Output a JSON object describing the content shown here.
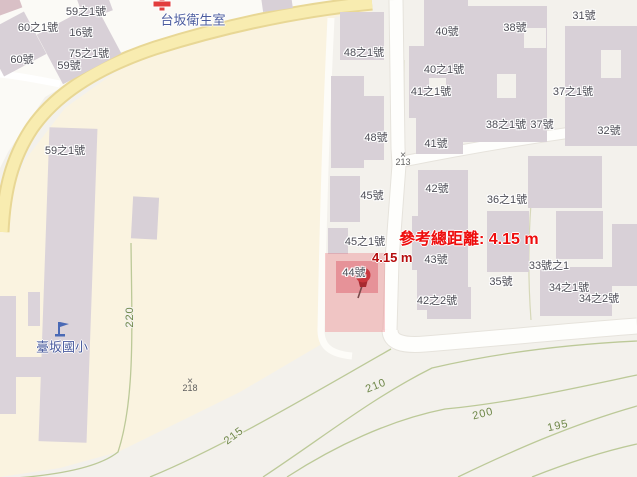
{
  "window": {
    "width": 637,
    "height": 477
  },
  "map": {
    "type": "topographic-street-map",
    "colors": {
      "building": "#d8d0d7",
      "school_ground": "#faf3e0",
      "background": "#f3f1ec",
      "road_yellow": "#f8ecb0",
      "road_white": "#fefefc",
      "contour_green": "#bcc998",
      "contour_label_green": "#6e8748",
      "place_label_blue": "#4a5b9e",
      "building_label_gray": "#4c4c55",
      "measurement_red": "#ee0d0d",
      "segment_red": "#b50d0d",
      "highlight_pink": "#f2b9bd",
      "marker_red": "#c9363c"
    },
    "labels": {
      "building_numbers": [
        {
          "text": "59之1號",
          "x": 86,
          "y": 11
        },
        {
          "text": "60之1號",
          "x": 38,
          "y": 27
        },
        {
          "text": "16號",
          "x": 81,
          "y": 32
        },
        {
          "text": "75之1號",
          "x": 89,
          "y": 53
        },
        {
          "text": "60號",
          "x": 22,
          "y": 59
        },
        {
          "text": "59號",
          "x": 69,
          "y": 65
        },
        {
          "text": "59之1號",
          "x": 65,
          "y": 150
        },
        {
          "text": "48之1號",
          "x": 364,
          "y": 52
        },
        {
          "text": "40號",
          "x": 447,
          "y": 31
        },
        {
          "text": "40之1號",
          "x": 444,
          "y": 69
        },
        {
          "text": "41之1號",
          "x": 431,
          "y": 91
        },
        {
          "text": "48號",
          "x": 376,
          "y": 137
        },
        {
          "text": "41號",
          "x": 436,
          "y": 143
        },
        {
          "text": "38號",
          "x": 515,
          "y": 27
        },
        {
          "text": "31號",
          "x": 584,
          "y": 15
        },
        {
          "text": "37之1號",
          "x": 573,
          "y": 91
        },
        {
          "text": "38之1號",
          "x": 506,
          "y": 124
        },
        {
          "text": "37號",
          "x": 542,
          "y": 124
        },
        {
          "text": "32號",
          "x": 609,
          "y": 130
        },
        {
          "text": "45號",
          "x": 372,
          "y": 195
        },
        {
          "text": "42號",
          "x": 437,
          "y": 188
        },
        {
          "text": "36之1號",
          "x": 507,
          "y": 199
        },
        {
          "text": "45之1號",
          "x": 365,
          "y": 241
        },
        {
          "text": "43號",
          "x": 436,
          "y": 259
        },
        {
          "text": "44號",
          "x": 354,
          "y": 272
        },
        {
          "text": "42之2號",
          "x": 437,
          "y": 300
        },
        {
          "text": "35號",
          "x": 501,
          "y": 281
        },
        {
          "text": "33號之1",
          "x": 549,
          "y": 265
        },
        {
          "text": "34之1號",
          "x": 569,
          "y": 287
        },
        {
          "text": "34之2號",
          "x": 599,
          "y": 298
        }
      ],
      "places": [
        {
          "text": "台坂衛生室",
          "x": 193,
          "y": 19
        },
        {
          "text": "臺坂國小",
          "x": 62,
          "y": 346
        }
      ],
      "contours": [
        {
          "text": "220",
          "x": 130,
          "y": 317,
          "rot": -90
        },
        {
          "text": "215",
          "x": 234,
          "y": 436,
          "rot": -37
        },
        {
          "text": "210",
          "x": 376,
          "y": 386,
          "rot": -22
        },
        {
          "text": "200",
          "x": 483,
          "y": 414,
          "rot": -14
        },
        {
          "text": "195",
          "x": 558,
          "y": 426,
          "rot": -13
        }
      ],
      "spot_elevations": [
        {
          "mark": "×",
          "value": "213",
          "x": 403,
          "y": 159
        },
        {
          "mark": "×",
          "value": "218",
          "x": 190,
          "y": 385
        }
      ]
    },
    "measurement": {
      "total_label": "參考總距離: 4.15 m",
      "segment_label": "4.15 m",
      "marker": {
        "x": 362,
        "y": 284,
        "at_building": "44號"
      }
    }
  }
}
